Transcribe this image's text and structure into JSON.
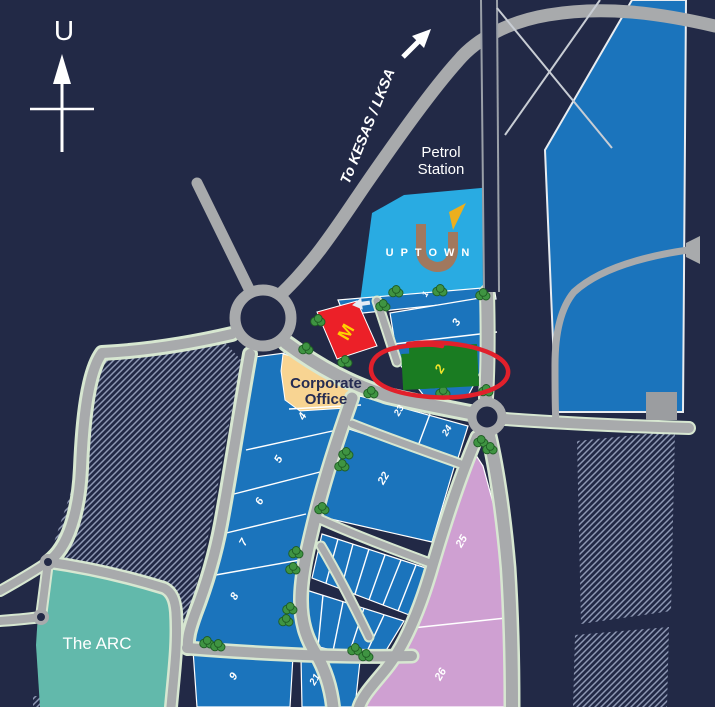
{
  "compass": {
    "label": "U"
  },
  "map": {
    "kesas_label": "To KESAS / LKSA",
    "petrol_station": [
      "Petrol",
      "Station"
    ],
    "uptown_label": "UPTOWN",
    "corporate_office": [
      "Corporate",
      "Office"
    ],
    "arc_label": "The ARC",
    "mcdonalds_m": "M"
  },
  "lots": [
    {
      "id": "lot-1",
      "label": "1"
    },
    {
      "id": "lot-2",
      "label": "2"
    },
    {
      "id": "lot-3",
      "label": "3"
    },
    {
      "id": "lot-4",
      "label": "4"
    },
    {
      "id": "lot-5",
      "label": "5"
    },
    {
      "id": "lot-6",
      "label": "6"
    },
    {
      "id": "lot-7",
      "label": "7"
    },
    {
      "id": "lot-8",
      "label": "8"
    },
    {
      "id": "lot-9",
      "label": "9"
    },
    {
      "id": "lot-21",
      "label": "21"
    },
    {
      "id": "lot-22",
      "label": "22"
    },
    {
      "id": "lot-23",
      "label": "23"
    },
    {
      "id": "lot-24",
      "label": "24"
    },
    {
      "id": "lot-25",
      "label": "25"
    },
    {
      "id": "lot-26",
      "label": "26"
    }
  ],
  "highlight": {
    "circled_lot": "2"
  },
  "colors": {
    "background": "#222946",
    "road_gray": "#a8aaac",
    "road_edge_mint": "#d7e7d1",
    "lot_blue": "#1b74bc",
    "uptown_blue": "#29abe2",
    "mcdonalds_red": "#ec2028",
    "mcdonalds_yellow": "#ffd200",
    "highlight_green": "#1a7c22",
    "highlight_circle_red": "#e1202b",
    "corporate_tan": "#f8d492",
    "pink_lot": "#cfa0d2",
    "arc_teal": "#62b9ab",
    "hatch_line": "#8e98b4",
    "number_yellow": "#efe32a",
    "uptown_logo_brown": "#a1785e"
  }
}
